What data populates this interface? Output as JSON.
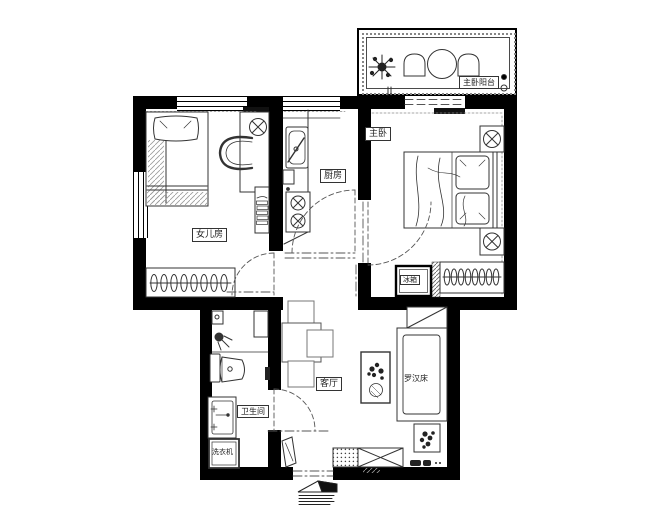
{
  "meta": {
    "type": "apartment-floor-plan",
    "background": "#ffffff",
    "wall_color": "#000000",
    "line_color": "#333333"
  },
  "rooms": {
    "daughter": {
      "label": "女儿房"
    },
    "kitchen": {
      "label": "厨房"
    },
    "master": {
      "label": "主卧"
    },
    "balcony": {
      "label": "主卧阳台"
    },
    "living": {
      "label": "客厅"
    },
    "bathroom": {
      "label": "卫生间"
    }
  },
  "furniture": {
    "fridge": {
      "label": "冰箱"
    },
    "daybed": {
      "label": "罗汉床"
    },
    "washer": {
      "label": "洗衣机"
    }
  }
}
